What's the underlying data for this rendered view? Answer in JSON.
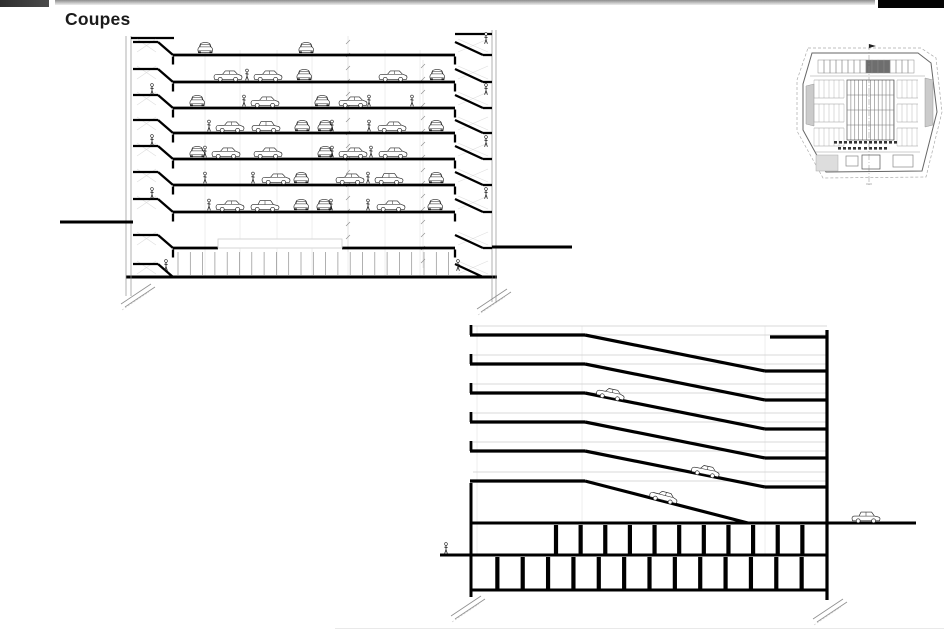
{
  "page": {
    "title": "Coupes",
    "background": "#ffffff"
  },
  "header": {
    "left_block": {
      "x": 0,
      "y": 0,
      "w": 49,
      "h": 7,
      "color": "#2e2e2e"
    },
    "rule": {
      "x": 55,
      "y": 0,
      "w": 820,
      "h": 5,
      "color_top": "#8d8d8d",
      "color_bottom": "#eeeeee"
    },
    "right_block": {
      "x": 878,
      "y": 0,
      "w": 66,
      "h": 8,
      "color": "#040404"
    }
  },
  "colors": {
    "ink": "#000000",
    "line": "#222222",
    "thin": "#8f8f8f",
    "faint": "#cccccc",
    "grid": "#dedede",
    "fill": "#ffffff",
    "ramp_fill": "#cbcbcb"
  },
  "section_a": {
    "wall_left_inner_x": 173,
    "wall_right_inner_x": 455,
    "core_left": {
      "outer_xs": [
        126,
        131
      ],
      "roof_y": 38,
      "half_x1": 133,
      "half_x2": 158
    },
    "core_right": {
      "outer_xs": [
        492,
        496
      ],
      "roof_y": 34,
      "half_x1": 483,
      "half_x2": 492
    },
    "floors": [
      55,
      82,
      108,
      133,
      159,
      185,
      212
    ],
    "ground_floor": {
      "ceiling_y": 248,
      "beam": {
        "x": 218,
        "y": 239,
        "w": 124,
        "h": 9
      },
      "mullion_y1": 252,
      "mullion_y2": 275,
      "mullion_x1": 178,
      "mullion_x2": 452,
      "mullion_step": 12.3,
      "bottom_y": 277
    },
    "core_extra_floors": [
      248,
      277
    ],
    "grade_left": {
      "y": 222,
      "x1": 60,
      "x2": 133
    },
    "grade_right": {
      "y": 247,
      "x1": 492,
      "x2": 572
    },
    "grid_xs": [
      205,
      240,
      277,
      312,
      348,
      385,
      420
    ],
    "dim_lines": [
      {
        "x": 348,
        "y1": 36,
        "y2": 252
      },
      {
        "x": 423,
        "y1": 60,
        "y2": 268
      }
    ],
    "levels": [
      {
        "y": 55,
        "items": [
          [
            "cf",
            197
          ],
          [
            "cf",
            298
          ]
        ]
      },
      {
        "y": 82,
        "items": [
          [
            "cs",
            213
          ],
          [
            "p",
            247
          ],
          [
            "cs",
            253
          ],
          [
            "cf",
            296
          ],
          [
            "cs",
            378
          ],
          [
            "cf",
            429
          ]
        ]
      },
      {
        "y": 108,
        "items": [
          [
            "cf",
            189
          ],
          [
            "p",
            244
          ],
          [
            "cs",
            250
          ],
          [
            "cf",
            314
          ],
          [
            "cs",
            338
          ],
          [
            "p",
            369
          ],
          [
            "p",
            412
          ]
        ]
      },
      {
        "y": 133,
        "items": [
          [
            "p",
            209
          ],
          [
            "cs",
            215
          ],
          [
            "cv",
            251
          ],
          [
            "cf",
            294
          ],
          [
            "cf",
            317
          ],
          [
            "p",
            332
          ],
          [
            "p",
            369
          ],
          [
            "cs",
            377
          ],
          [
            "cf",
            428
          ]
        ]
      },
      {
        "y": 159,
        "items": [
          [
            "cf",
            189
          ],
          [
            "p",
            205
          ],
          [
            "cs",
            211
          ],
          [
            "cs",
            253
          ],
          [
            "cf",
            317
          ],
          [
            "p",
            332
          ],
          [
            "cs",
            338
          ],
          [
            "p",
            371
          ],
          [
            "cs",
            378
          ]
        ]
      },
      {
        "y": 185,
        "items": [
          [
            "p",
            205
          ],
          [
            "p",
            253
          ],
          [
            "cs",
            261
          ],
          [
            "cf",
            293
          ],
          [
            "cs",
            335
          ],
          [
            "p",
            368
          ],
          [
            "cv",
            374
          ],
          [
            "cf",
            428
          ]
        ]
      },
      {
        "y": 212,
        "items": [
          [
            "p",
            209
          ],
          [
            "cs",
            215
          ],
          [
            "cv",
            250
          ],
          [
            "cf",
            293
          ],
          [
            "cf",
            316
          ],
          [
            "p",
            331
          ],
          [
            "p",
            368
          ],
          [
            "cs",
            376
          ],
          [
            "cf",
            427
          ]
        ]
      }
    ],
    "core_people_left": [
      [
        152,
        95
      ],
      [
        152,
        146
      ],
      [
        152,
        199
      ],
      [
        166,
        271
      ]
    ],
    "core_people_right": [
      [
        486,
        44
      ],
      [
        486,
        95
      ],
      [
        486,
        147
      ],
      [
        486,
        199
      ],
      [
        458,
        271
      ]
    ]
  },
  "plan_thumb": {
    "outline": [
      [
        812,
        53
      ],
      [
        918,
        53
      ],
      [
        931,
        63
      ],
      [
        937,
        112
      ],
      [
        922,
        171
      ],
      [
        826,
        172
      ],
      [
        803,
        130
      ],
      [
        803,
        84
      ]
    ],
    "dashed": [
      [
        808,
        48
      ],
      [
        921,
        48
      ],
      [
        936,
        58
      ],
      [
        942,
        112
      ],
      [
        926,
        177
      ],
      [
        823,
        178
      ],
      [
        797,
        131
      ],
      [
        797,
        80
      ]
    ],
    "top_row": {
      "x1": 818,
      "x2": 914,
      "y1": 60,
      "y2": 73,
      "n": 16,
      "dark": [
        8,
        9,
        10,
        11
      ]
    },
    "divider_y": 76,
    "wings": {
      "band_ys": [
        80,
        104,
        128
      ],
      "band_h": 18,
      "left": [
        814,
        844
      ],
      "right": [
        897,
        918
      ],
      "step": 5
    },
    "center": {
      "x1": 847,
      "x2": 894,
      "y1": 80,
      "y2": 140,
      "step": 3.9,
      "row_ys": [
        95,
        110,
        125
      ]
    },
    "ramps": [
      [
        [
          806,
          86
        ],
        [
          814,
          84
        ],
        [
          814,
          126
        ],
        [
          806,
          124
        ]
      ],
      [
        [
          925,
          78
        ],
        [
          933,
          80
        ],
        [
          933,
          125
        ],
        [
          925,
          127
        ]
      ]
    ],
    "dash_rows": [
      {
        "x1": 834,
        "x2": 894,
        "y": 141
      },
      {
        "x1": 838,
        "x2": 858,
        "y": 147
      },
      {
        "x1": 864,
        "x2": 884,
        "y": 147
      }
    ],
    "rooms_line_y": 152,
    "rooms": [
      {
        "x": 862,
        "y": 155,
        "w": 18,
        "h": 14,
        "s": "#555555"
      },
      {
        "x": 846,
        "y": 156,
        "w": 12,
        "h": 10,
        "s": "#888888"
      },
      {
        "x": 893,
        "y": 155,
        "w": 20,
        "h": 12,
        "s": "#888888"
      }
    ],
    "hatch_room": {
      "x": 816,
      "y": 155,
      "w": 22,
      "h": 16
    },
    "centerline": {
      "x": 869,
      "y1": 44,
      "y2": 186
    },
    "flag": {
      "x": 869,
      "y": 44
    }
  },
  "section_b": {
    "left_x": 470,
    "flat_end_x": 585,
    "slope_end_x": 765,
    "wall_right_x": 827,
    "left_flat_ys": [
      335,
      364,
      393,
      422,
      451
    ],
    "last_flat": {
      "y": 481,
      "slope_to_x": 748,
      "slope_to_y": 523
    },
    "drop": 36,
    "top_right_flat": {
      "y": 337,
      "x1": 770,
      "x2": 827
    },
    "ceil_offset": 9,
    "grid_xs": [
      477,
      582,
      765
    ],
    "wall_left": {
      "x": 471,
      "y1": 483,
      "y2": 597
    },
    "wall_right": {
      "y1": 330,
      "y2": 600
    },
    "deck_line": {
      "y": 523,
      "x1": 470,
      "x2": 916
    },
    "grade_line": {
      "y": 555,
      "x1": 440,
      "x2": 827
    },
    "bottom_line": {
      "y": 590,
      "x1": 470,
      "x2": 827
    },
    "cols_upper": {
      "y1": 523,
      "y2": 555,
      "x1": 556,
      "x2": 827,
      "n": 11
    },
    "cols_lower": {
      "y1": 555,
      "y2": 590,
      "x1": 472,
      "x2": 827,
      "n": 14
    },
    "cars": [
      {
        "t": "cs",
        "x": 595,
        "y": 395.5,
        "rot": 11.3
      },
      {
        "t": "cs",
        "x": 690,
        "y": 472.5,
        "rot": 11.3
      },
      {
        "t": "cs",
        "x": 648,
        "y": 497.5,
        "rot": 14.5
      },
      {
        "t": "cv",
        "x": 851,
        "y": 522,
        "rot": 0
      }
    ],
    "people": [
      [
        446,
        554
      ]
    ]
  }
}
